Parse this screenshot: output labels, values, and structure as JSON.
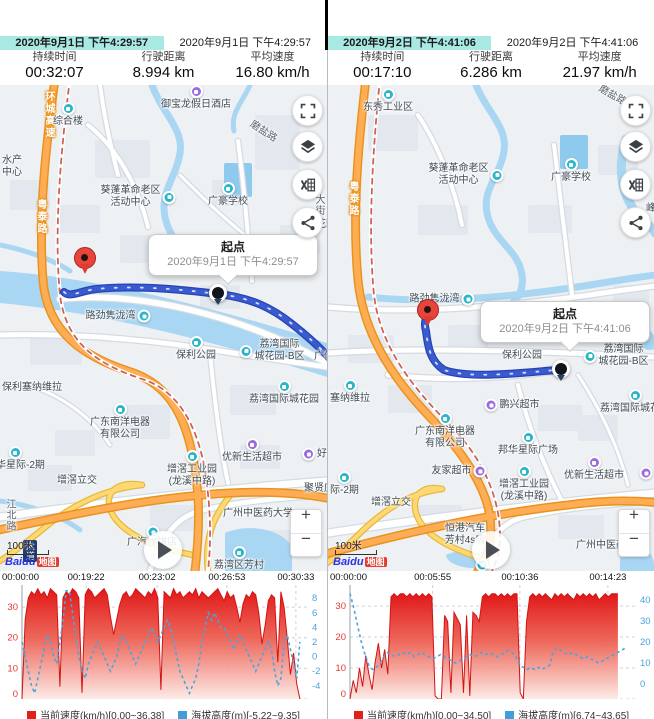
{
  "colors": {
    "tab_active_bg": "#a9e9e4",
    "route_blue": "#3a5ad1",
    "poi_teal": "#2ab5c9",
    "poi_purple": "#9b6be0",
    "highway_orange": "#ffad55",
    "water": "#a9d6f2",
    "chart_red": "#e02020",
    "chart_blue": "#4ba3dd"
  },
  "panels": [
    {
      "tabs": [
        {
          "label": "2020年9月1日 下午4:29:57",
          "active": true
        },
        {
          "label": "2020年9月1日 下午4:29:57",
          "active": false
        }
      ],
      "stats": [
        {
          "label": "持续时间",
          "value": "00:32:07"
        },
        {
          "label": "行驶距离",
          "value": "8.994 km"
        },
        {
          "label": "平均速度",
          "value": "16.80 km/h"
        }
      ],
      "callout": {
        "title": "起点",
        "subtitle": "2020年9月1日 下午4:29:57"
      },
      "map": {
        "scale": "100米",
        "brand_latin": "Baidu",
        "brand_cn": "地图",
        "zoom_in": "+",
        "zoom_out": "−",
        "controls": [
          "fullscreen",
          "layers",
          "export-excel",
          "share"
        ],
        "markers": {
          "pin": {
            "x": 85,
            "y": 188
          },
          "dot": {
            "x": 218,
            "y": 208
          },
          "callout": {
            "x": 148,
            "y": 149,
            "w": 152,
            "pf": 0.47
          }
        },
        "labels": [
          {
            "l": [
              "环城高速"
            ],
            "x": 48,
            "y": 30,
            "c": "rv"
          },
          {
            "l": [
              "综合楼"
            ],
            "x": 68,
            "y": 30,
            "ic": "t",
            "ip": "top"
          },
          {
            "l": [
              "御宝龙假日酒店"
            ],
            "x": 196,
            "y": 13,
            "ic": "p",
            "ip": "top"
          },
          {
            "l": [
              "磨盐路"
            ],
            "x": 263,
            "y": 47,
            "c": "rd",
            "rot": 33
          },
          {
            "l": [
              "水产",
              "中心"
            ],
            "x": 2,
            "y": 82,
            "ax": "l"
          },
          {
            "l": [
              "葵蓬革命老区",
              "活动中心"
            ],
            "x": 138,
            "y": 112,
            "ic": "t",
            "ip": "right"
          },
          {
            "l": [
              "广豪学校"
            ],
            "x": 228,
            "y": 110,
            "ic": "t",
            "ip": "top"
          },
          {
            "l": [
              "粤泰路"
            ],
            "x": 40,
            "y": 132,
            "c": "rv"
          },
          {
            "l": [
              "大街"
            ],
            "x": 318,
            "y": 120,
            "c": "rdv"
          },
          {
            "l": [
              "峰越花园"
            ],
            "x": 296,
            "y": 140,
            "ax": "l"
          },
          {
            "l": [
              "路劲隽泷湾"
            ],
            "x": 118,
            "y": 231,
            "ic": "t",
            "ip": "right"
          },
          {
            "l": [
              "保利公园"
            ],
            "x": 196,
            "y": 264,
            "ic": "t",
            "ip": "top"
          },
          {
            "l": [
              "荔湾国际",
              "城花园-B区"
            ],
            "x": 272,
            "y": 266,
            "ic": "t",
            "ip": "left"
          },
          {
            "l": [
              "广佛"
            ],
            "x": 314,
            "y": 272,
            "ax": "l"
          },
          {
            "l": [
              "保利塞纳维拉"
            ],
            "x": 2,
            "y": 303,
            "ax": "l"
          },
          {
            "l": [
              "荔湾国际城花园"
            ],
            "x": 284,
            "y": 308,
            "ic": "t",
            "ip": "top"
          },
          {
            "l": [
              "广东南洋电器",
              "有限公司"
            ],
            "x": 120,
            "y": 337,
            "ic": "t",
            "ip": "top"
          },
          {
            "l": [
              "邦华星际-2期"
            ],
            "x": -14,
            "y": 374,
            "ic": "t",
            "ip": "top",
            "ax": "l"
          },
          {
            "l": [
              "优新生活超市"
            ],
            "x": 252,
            "y": 366,
            "ic": "p",
            "ip": "top"
          },
          {
            "l": [
              "好再来"
            ],
            "x": 302,
            "y": 369,
            "ic": "p",
            "ip": "left",
            "ax": "l"
          },
          {
            "l": [
              "增滘工业园",
              "(龙溪中路)"
            ],
            "x": 192,
            "y": 384,
            "ic": "t",
            "ip": "top"
          },
          {
            "l": [
              "增滘立交"
            ],
            "x": 77,
            "y": 396
          },
          {
            "l": [
              "聚贤庄"
            ],
            "x": 304,
            "y": 404,
            "ax": "l"
          },
          {
            "l": [
              "江北路"
            ],
            "x": 9,
            "y": 430,
            "c": "rdv"
          },
          {
            "l": [
              "广州中医药大学"
            ],
            "x": 258,
            "y": 429
          },
          {
            "l": [
              "广汽传祺店"
            ],
            "x": 152,
            "y": 458
          },
          {
            "l": [
              "荔湾区芳村"
            ],
            "x": 239,
            "y": 474,
            "ic": "t",
            "ip": "top"
          },
          {
            "l": [],
            "x": 153,
            "y": 447,
            "ic": "t"
          },
          {
            "l": [
              "大道"
            ],
            "x": 30,
            "y": 466,
            "c": "sh"
          }
        ]
      }
    },
    {
      "tabs": [
        {
          "label": "2020年9月2日 下午4:41:06",
          "active": true
        },
        {
          "label": "2020年9月2日 下午4:41:06",
          "active": false
        }
      ],
      "stats": [
        {
          "label": "持续时间",
          "value": "00:17:10"
        },
        {
          "label": "行驶距离",
          "value": "6.286 km"
        },
        {
          "label": "平均速度",
          "value": "21.97 km/h"
        }
      ],
      "callout": {
        "title": "起点",
        "subtitle": "2020年9月2日 下午4:41:06"
      },
      "map": {
        "scale": "100米",
        "brand_latin": "Baidu",
        "brand_cn": "地图",
        "zoom_in": "+",
        "zoom_out": "−",
        "controls": [
          "fullscreen",
          "layers",
          "export-excel",
          "share"
        ],
        "markers": {
          "pin": {
            "x": 100,
            "y": 240
          },
          "dot": {
            "x": 233,
            "y": 284
          },
          "callout": {
            "x": 152,
            "y": 216,
            "w": 152,
            "pf": 0.53
          }
        },
        "labels": [
          {
            "l": [
              "东秀工业区"
            ],
            "x": 60,
            "y": 16,
            "ic": "t",
            "ip": "top"
          },
          {
            "l": [
              "磨盐路"
            ],
            "x": 284,
            "y": 11,
            "c": "rd",
            "rot": 30
          },
          {
            "l": [
              "葵蓬革命老区",
              "活动中心"
            ],
            "x": 138,
            "y": 90,
            "ic": "t",
            "ip": "right"
          },
          {
            "l": [
              "广豪学校"
            ],
            "x": 243,
            "y": 86,
            "ic": "t",
            "ip": "top"
          },
          {
            "l": [
              "粤泰路"
            ],
            "x": 24,
            "y": 114,
            "c": "rv"
          },
          {
            "l": [
              "峰越花园"
            ],
            "x": 318,
            "y": 124,
            "ax": "l"
          },
          {
            "l": [
              "路劲隽泷湾"
            ],
            "x": 114,
            "y": 214,
            "ic": "t",
            "ip": "right"
          },
          {
            "l": [
              "保利公园"
            ],
            "x": 194,
            "y": 271
          },
          {
            "l": [
              "荔湾国际",
              "城花园-B区"
            ],
            "x": 288,
            "y": 271,
            "ic": "t",
            "ip": "left"
          },
          {
            "l": [
              "塞纳维拉"
            ],
            "x": 2,
            "y": 307,
            "ic": "t",
            "ip": "top",
            "ax": "l"
          },
          {
            "l": [
              "鹏兴超市"
            ],
            "x": 184,
            "y": 320,
            "ic": "p",
            "ip": "left"
          },
          {
            "l": [
              "荔湾国际城花园"
            ],
            "x": 272,
            "y": 317,
            "ic": "t",
            "ip": "top",
            "ax": "l"
          },
          {
            "l": [
              "广东南洋电器",
              "有限公司"
            ],
            "x": 117,
            "y": 346,
            "ic": "t",
            "ip": "top"
          },
          {
            "l": [
              "邦华星际广场"
            ],
            "x": 200,
            "y": 359,
            "ic": "t",
            "ip": "top"
          },
          {
            "l": [
              "友家超市"
            ],
            "x": 131,
            "y": 386,
            "ic": "p",
            "ip": "right"
          },
          {
            "l": [
              "增滘工业园",
              "(龙溪中路)"
            ],
            "x": 196,
            "y": 399,
            "ic": "t",
            "ip": "top"
          },
          {
            "l": [
              "优新生活超市"
            ],
            "x": 266,
            "y": 384,
            "ic": "p",
            "ip": "top"
          },
          {
            "l": [],
            "x": 318,
            "y": 388,
            "ic": "p"
          },
          {
            "l": [
              "际-2期"
            ],
            "x": 2,
            "y": 399,
            "ic": "t",
            "ip": "top",
            "ax": "l"
          },
          {
            "l": [
              "增滘立交"
            ],
            "x": 63,
            "y": 418
          },
          {
            "l": [
              "恒港汽车",
              "芳村4s店"
            ],
            "x": 137,
            "y": 450
          },
          {
            "l": [
              "广州中医药大学"
            ],
            "x": 248,
            "y": 461,
            "ax": "l"
          },
          {
            "l": [],
            "x": 154,
            "y": 480,
            "ic": "t"
          }
        ]
      }
    }
  ],
  "chart_data": [
    {
      "type": "area+line",
      "x_ticks": [
        {
          "label": "00:00:00",
          "f": 0.0
        },
        {
          "label": "00:19:22",
          "f": 0.225
        },
        {
          "label": "00:23:02",
          "f": 0.474
        },
        {
          "label": "00:26:53",
          "f": 0.719
        },
        {
          "label": "00:30:33",
          "f": 0.961
        }
      ],
      "y_left": {
        "ticks": [
          0,
          10,
          20,
          30
        ],
        "range": [
          0,
          37.2
        ],
        "color": "#e53935"
      },
      "y_right": {
        "ticks": [
          -4,
          -2,
          0,
          2,
          4,
          6,
          8
        ],
        "range": [
          -5.8,
          9.8
        ],
        "color": "#4ba3dd"
      },
      "speed": {
        "name": "当前速度(km/h)",
        "min": 0.0,
        "max": 36.38,
        "end_f": 0.975,
        "values": [
          0,
          26,
          33,
          35,
          34,
          36,
          34,
          35,
          33,
          36,
          35,
          34,
          4,
          33,
          35,
          34,
          36,
          35,
          33,
          2,
          34,
          36,
          35,
          33,
          34,
          35,
          36,
          34,
          27,
          21,
          26,
          31,
          34,
          35,
          33,
          34,
          36,
          35,
          34,
          33,
          35,
          34,
          36,
          33,
          3,
          35,
          34,
          33,
          36,
          34,
          35,
          33,
          34,
          35,
          34,
          36,
          33,
          35,
          34,
          33,
          34,
          35,
          36,
          34,
          32,
          35,
          33,
          34,
          30,
          25,
          31,
          34,
          33,
          35,
          34,
          28,
          18,
          24,
          32,
          34,
          33,
          12,
          35,
          30,
          20,
          8,
          15,
          5,
          0
        ]
      },
      "elevation": {
        "name": "海拔高度(m)",
        "min": -5.22,
        "max": 9.35,
        "end_f": 0.975,
        "values": [
          2,
          0,
          -2,
          -4,
          -5,
          -3,
          -1,
          1,
          3,
          2,
          0,
          -1,
          2,
          5,
          9,
          9,
          6,
          3,
          0,
          -2,
          -3,
          -1,
          0,
          1,
          2,
          1,
          0,
          -1,
          -2,
          -1,
          0,
          2,
          3,
          2,
          1,
          0,
          -1,
          0,
          1,
          2,
          3,
          4,
          3,
          2,
          3,
          4,
          5,
          4,
          2,
          0,
          -2,
          -3,
          -4,
          -5,
          -4,
          -3,
          -1,
          2,
          4,
          6,
          5,
          6,
          5,
          4,
          4,
          3,
          2,
          1,
          2,
          3,
          2,
          1,
          0,
          -1,
          -2,
          -1,
          0,
          1,
          2,
          1,
          -2,
          -4,
          -3,
          2,
          3,
          1,
          -1,
          -3,
          2
        ]
      },
      "legend": [
        {
          "color": "#e0211a",
          "label": "当前速度(km/h)[0.00~36.38]"
        },
        {
          "color": "#3f9fd8",
          "label": "海拔高度(m)[-5.22~9.35]"
        }
      ]
    },
    {
      "type": "area+line",
      "x_ticks": [
        {
          "label": "00:00:00",
          "f": 0.0
        },
        {
          "label": "00:05:55",
          "f": 0.29
        },
        {
          "label": "00:10:36",
          "f": 0.596
        },
        {
          "label": "00:14:23",
          "f": 0.905
        }
      ],
      "y_left": {
        "ticks": [
          0,
          10,
          20,
          30
        ],
        "range": [
          0,
          36.8
        ],
        "color": "#e53935"
      },
      "y_right": {
        "ticks": [
          0,
          10,
          20,
          30,
          40
        ],
        "range": [
          -7,
          47
        ],
        "color": "#4ba3dd"
      },
      "speed": {
        "name": "当前速度(km/h)",
        "min": 0.0,
        "max": 34.5,
        "end_f": 0.94,
        "values": [
          0,
          6,
          2,
          10,
          4,
          14,
          8,
          3,
          12,
          18,
          10,
          16,
          8,
          33,
          34,
          33,
          34,
          34,
          33,
          34,
          33,
          34,
          33,
          34,
          33,
          34,
          33,
          1,
          0,
          0,
          27,
          25,
          2,
          28,
          26,
          24,
          2,
          27,
          1,
          28,
          27,
          25,
          33,
          34,
          33,
          34,
          34,
          33,
          34,
          33,
          34,
          33,
          34,
          34,
          2,
          0,
          25,
          33,
          34,
          33,
          34,
          33,
          34,
          33,
          32,
          34,
          33,
          34,
          33,
          34,
          33,
          32,
          34,
          33,
          34,
          33,
          34,
          33,
          34,
          32,
          33,
          34,
          33,
          34,
          34,
          34
        ]
      },
      "elevation": {
        "name": "海拔高度(m)",
        "min": 6.74,
        "max": 43.65,
        "end_f": 0.965,
        "values": [
          43,
          36,
          28,
          20,
          14,
          9,
          7,
          8,
          10,
          13,
          15,
          14,
          13,
          14,
          15,
          14,
          15,
          13,
          14,
          15,
          14,
          13,
          12,
          13,
          14,
          13,
          12,
          11,
          10,
          11,
          12,
          13,
          14,
          13,
          14,
          15,
          14,
          15,
          14,
          13,
          14,
          15,
          16,
          15,
          13,
          9,
          8,
          7,
          8,
          7,
          8,
          7,
          8,
          9,
          16,
          17,
          16,
          15,
          14,
          15,
          14,
          13,
          12,
          13,
          12,
          11,
          10,
          11,
          12,
          13,
          14,
          15,
          16,
          17
        ]
      },
      "legend": [
        {
          "color": "#e0211a",
          "label": "当前速度(km/h)[0.00~34.50]"
        },
        {
          "color": "#3f9fd8",
          "label": "海拔高度(m)[6.74~43.65]"
        }
      ]
    }
  ]
}
